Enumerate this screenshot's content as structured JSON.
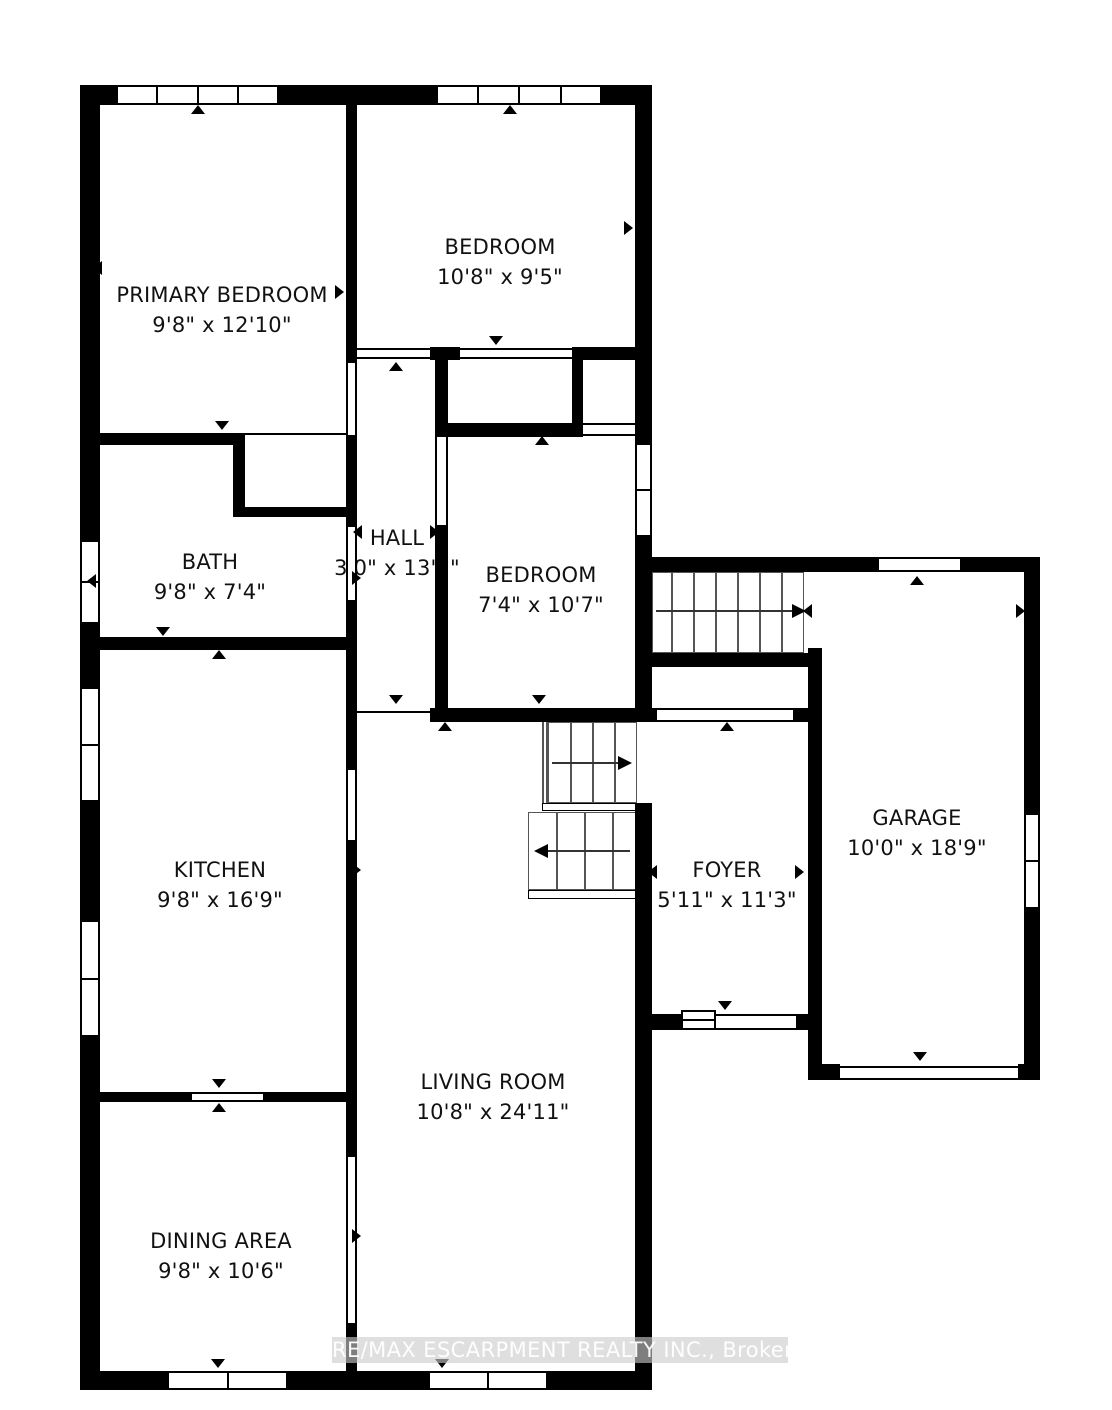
{
  "plan": {
    "type": "residential-floor-plan",
    "rooms": [
      {
        "id": "primary-bedroom",
        "name": "PRIMARY BEDROOM",
        "dims": "9'8\" x 12'10\""
      },
      {
        "id": "bedroom-north",
        "name": "BEDROOM",
        "dims": "10'8\" x 9'5\""
      },
      {
        "id": "bath",
        "name": "BATH",
        "dims": "9'8\" x 7'4\""
      },
      {
        "id": "hall",
        "name": "HALL",
        "dims": "3'0\" x 13'1\""
      },
      {
        "id": "bedroom-south",
        "name": "BEDROOM",
        "dims": "7'4\" x 10'7\""
      },
      {
        "id": "kitchen",
        "name": "KITCHEN",
        "dims": "9'8\" x 16'9\""
      },
      {
        "id": "garage",
        "name": "GARAGE",
        "dims": "10'0\" x 18'9\""
      },
      {
        "id": "foyer",
        "name": "FOYER",
        "dims": "5'11\" x 11'3\""
      },
      {
        "id": "living-room",
        "name": "LIVING ROOM",
        "dims": "10'8\" x 24'11\""
      },
      {
        "id": "dining-area",
        "name": "DINING AREA",
        "dims": "9'8\" x 10'6\""
      }
    ],
    "watermark": "RE/MAX ESCARPMENT REALTY INC., Brokerage",
    "colors": {
      "walls": "#000000",
      "background": "#ffffff",
      "watermark_band": "#cbcbcb",
      "watermark_text": "#ffffff"
    }
  }
}
